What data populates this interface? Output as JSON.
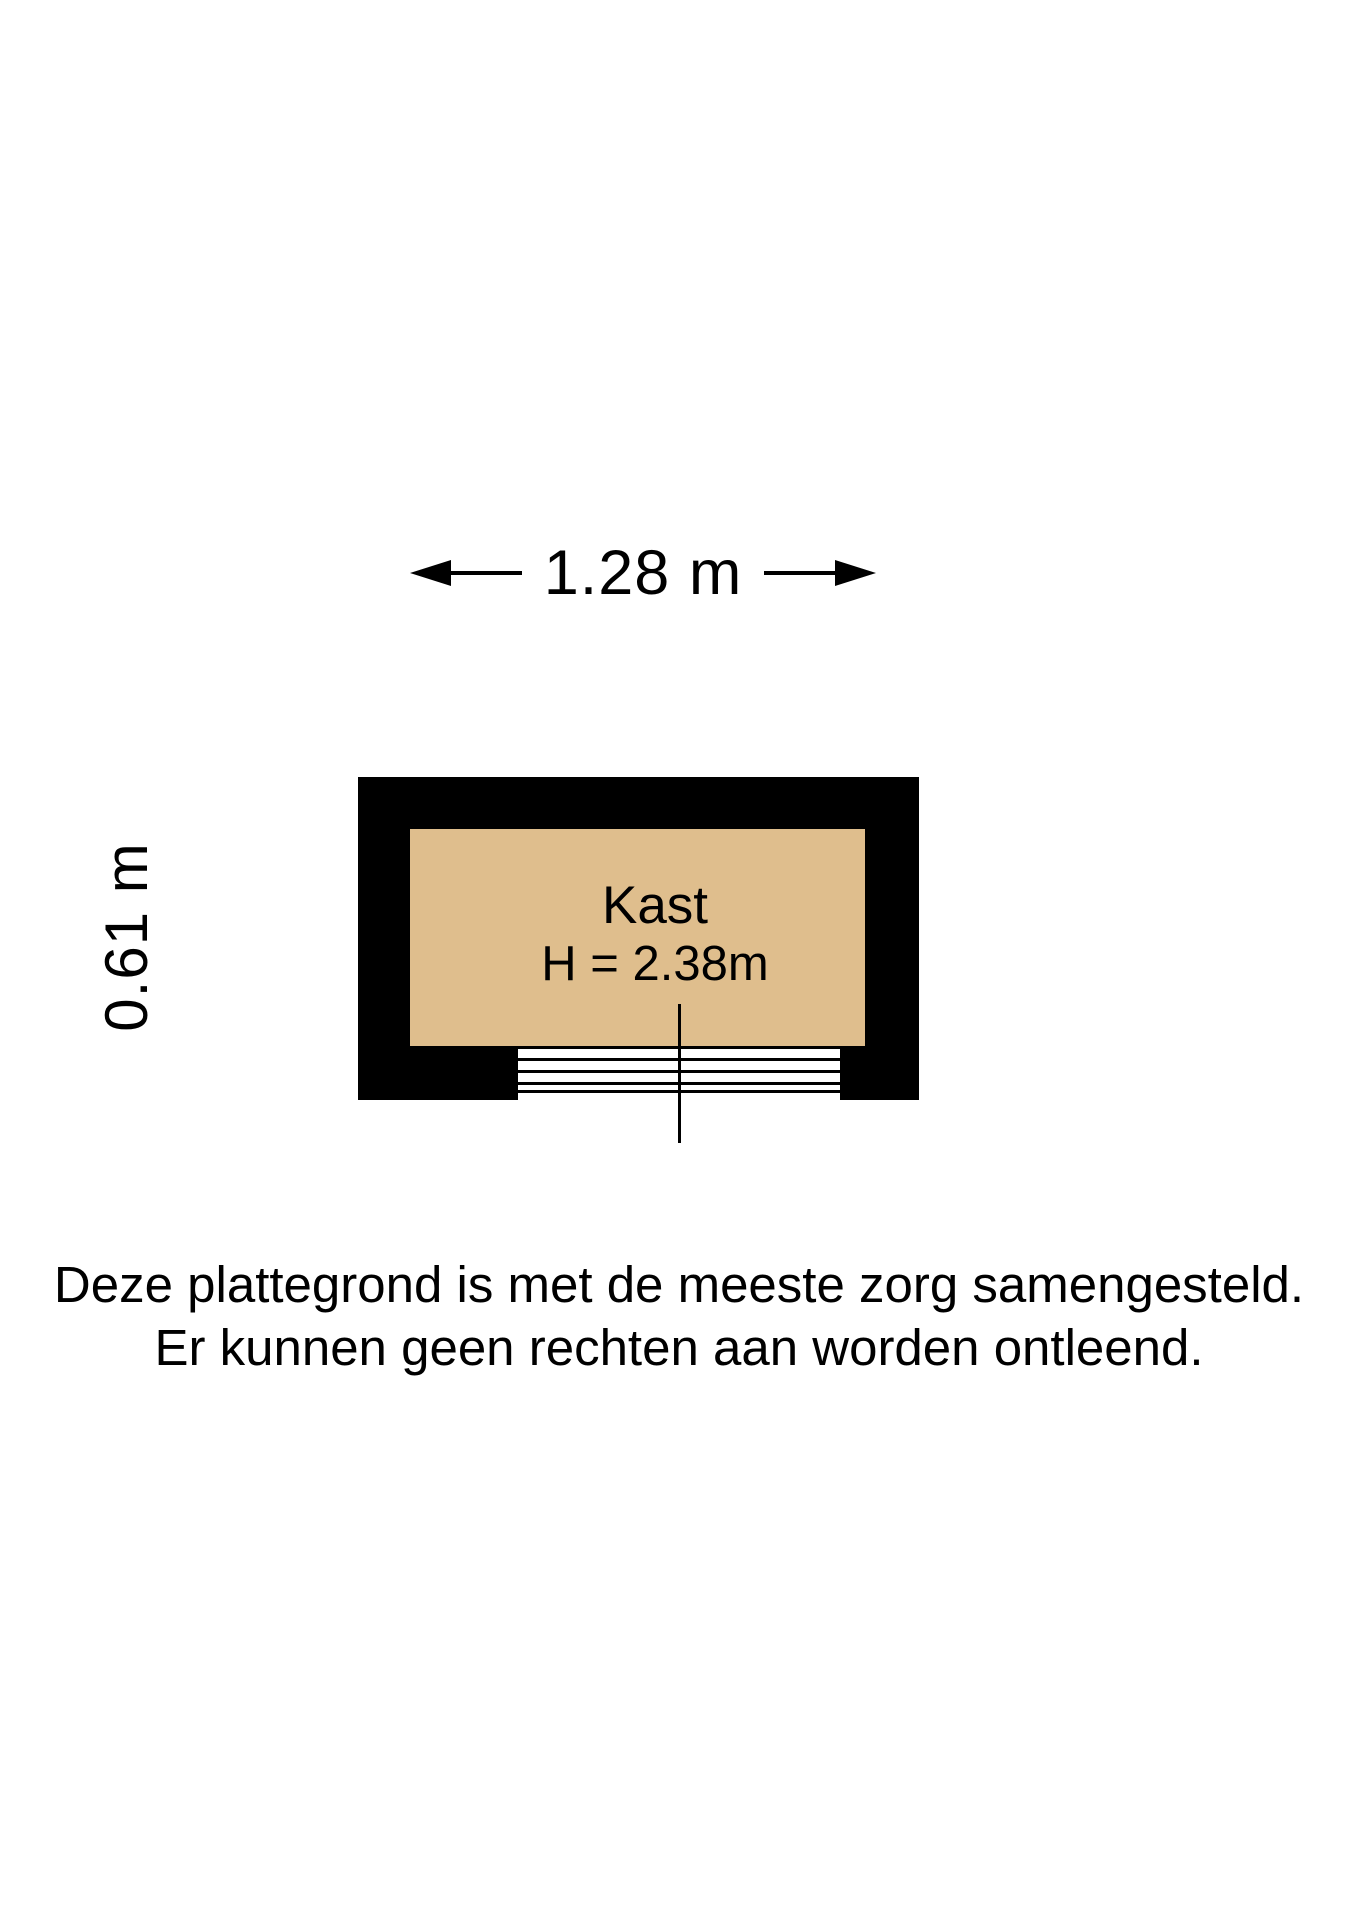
{
  "floorplan": {
    "dimensions": {
      "width_label": "1.28 m",
      "depth_label": "0.61 m"
    },
    "room": {
      "name": "Kast",
      "ceiling_height_label": "H = 2.38m"
    },
    "colors": {
      "wall": "#000000",
      "floor": "#DFBE8D",
      "line": "#000000",
      "background": "#FFFFFF"
    }
  },
  "disclaimer": {
    "line1": "Deze plattegrond is met de meeste zorg samengesteld.",
    "line2": "Er kunnen geen rechten aan worden ontleend."
  }
}
